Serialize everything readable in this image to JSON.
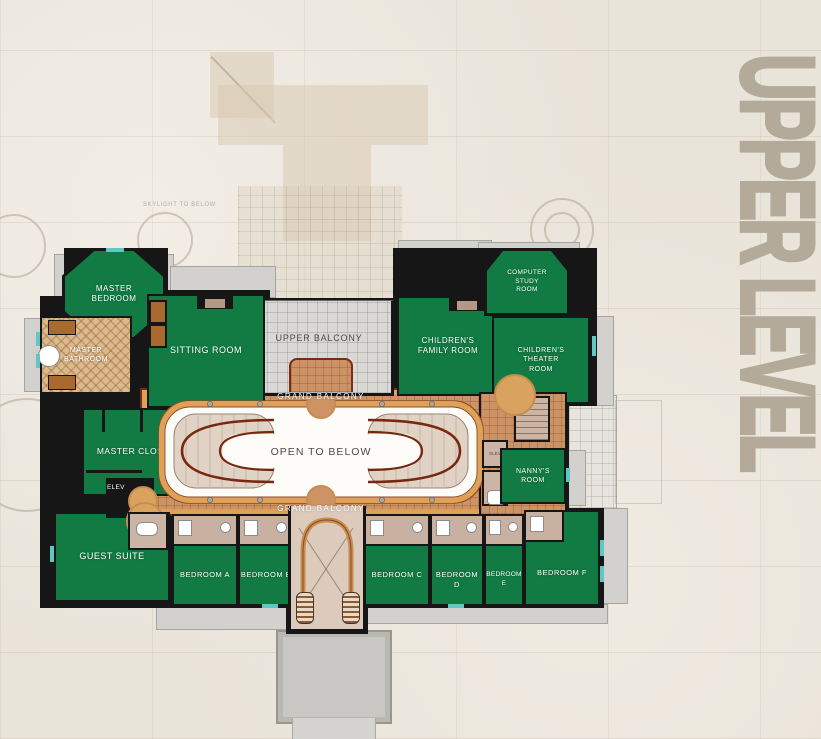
{
  "title": {
    "text": "UPPER LEVEL",
    "color": "#b3aa99"
  },
  "ghost": {
    "skylight_label": "SKYLIGHT TO BELOW"
  },
  "colors": {
    "room_green": "#117b43",
    "balcony_tan": "#cd9365",
    "trim_orange": "#dfa057",
    "rail_brown": "#7a2c18",
    "upper_balcony_gray": "#d9d8d5",
    "accent_teal": "#5fc8c6",
    "wall_black": "#161616",
    "title_taupe": "#b3aa99",
    "background_stone": "#e9e4da",
    "bath_mauve": "#cdb5a6",
    "stair_mauve": "#dccaba",
    "walkway_gray": "#c8c7c4"
  },
  "rooms": {
    "master_bedroom": "MASTER\nBEDROOM",
    "sitting_room": "SITTING ROOM",
    "master_bathroom": "MASTER\nBATHROOM",
    "upper_balcony": "UPPER BALCONY",
    "childrens_family_room": "CHILDREN'S\nFAMILY ROOM",
    "computer_study_room": "COMPUTER\nSTUDY\nROOM",
    "childrens_theater_room": "CHILDREN'S\nTHEATER\nROOM",
    "grand_balcony_top": "GRAND BALCONY",
    "grand_balcony_bottom": "GRAND BALCONY",
    "open_to_below": "OPEN TO BELOW",
    "master_closet": "MASTER CLOSET",
    "elevator": "ELEV",
    "service_elevator": "ELEV",
    "guest_suite": "GUEST SUITE",
    "nannys_room": "NANNY'S\nROOM",
    "bedroom_a": "BEDROOM A",
    "bedroom_b": "BEDROOM B",
    "bedroom_c": "BEDROOM C",
    "bedroom_d": "BEDROOM D",
    "bedroom_e": "BEDROOM E",
    "bedroom_f": "BEDROOM F"
  }
}
